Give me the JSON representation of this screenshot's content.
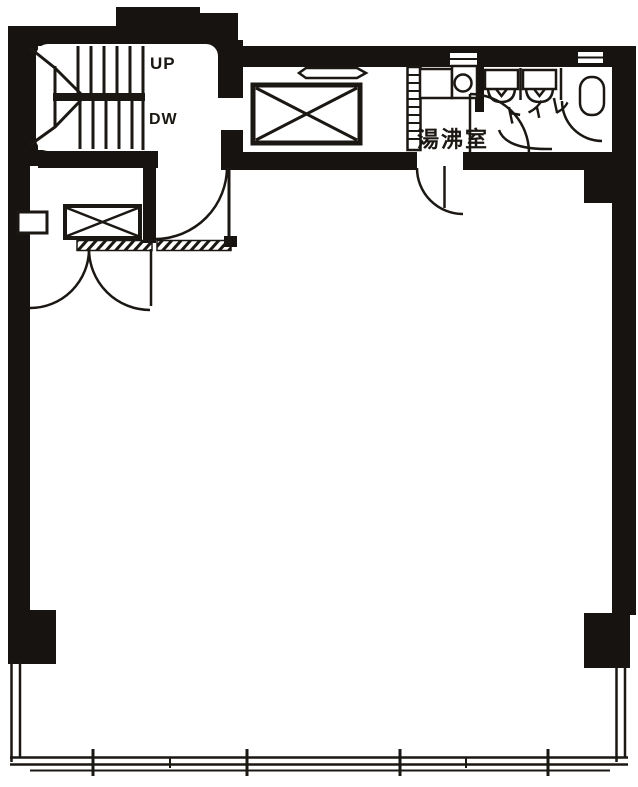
{
  "plan": {
    "labels": {
      "stairs_up": "UP",
      "stairs_down": "DW",
      "kitchenette": "湯沸室",
      "toilet": "トイレ"
    },
    "colors": {
      "wall": "#171310",
      "ink": "#1b1713",
      "background": "#ffffff"
    },
    "icons": [
      "stair-treads-icon",
      "stair-direction-arrow-icon",
      "elevator-shaft-x-icon",
      "service-shaft-x-icon",
      "door-swing-arc-icon",
      "double-door-swing-icon",
      "sink-circle-icon",
      "kitchen-counter-icon",
      "toilet-fixture-icon",
      "toilet-stall-partition-icon",
      "washbasin-oval-icon",
      "wall-vent-slit-icon",
      "window-mullion-icon",
      "hatched-threshold-icon",
      "column-pillar-icon"
    ]
  }
}
